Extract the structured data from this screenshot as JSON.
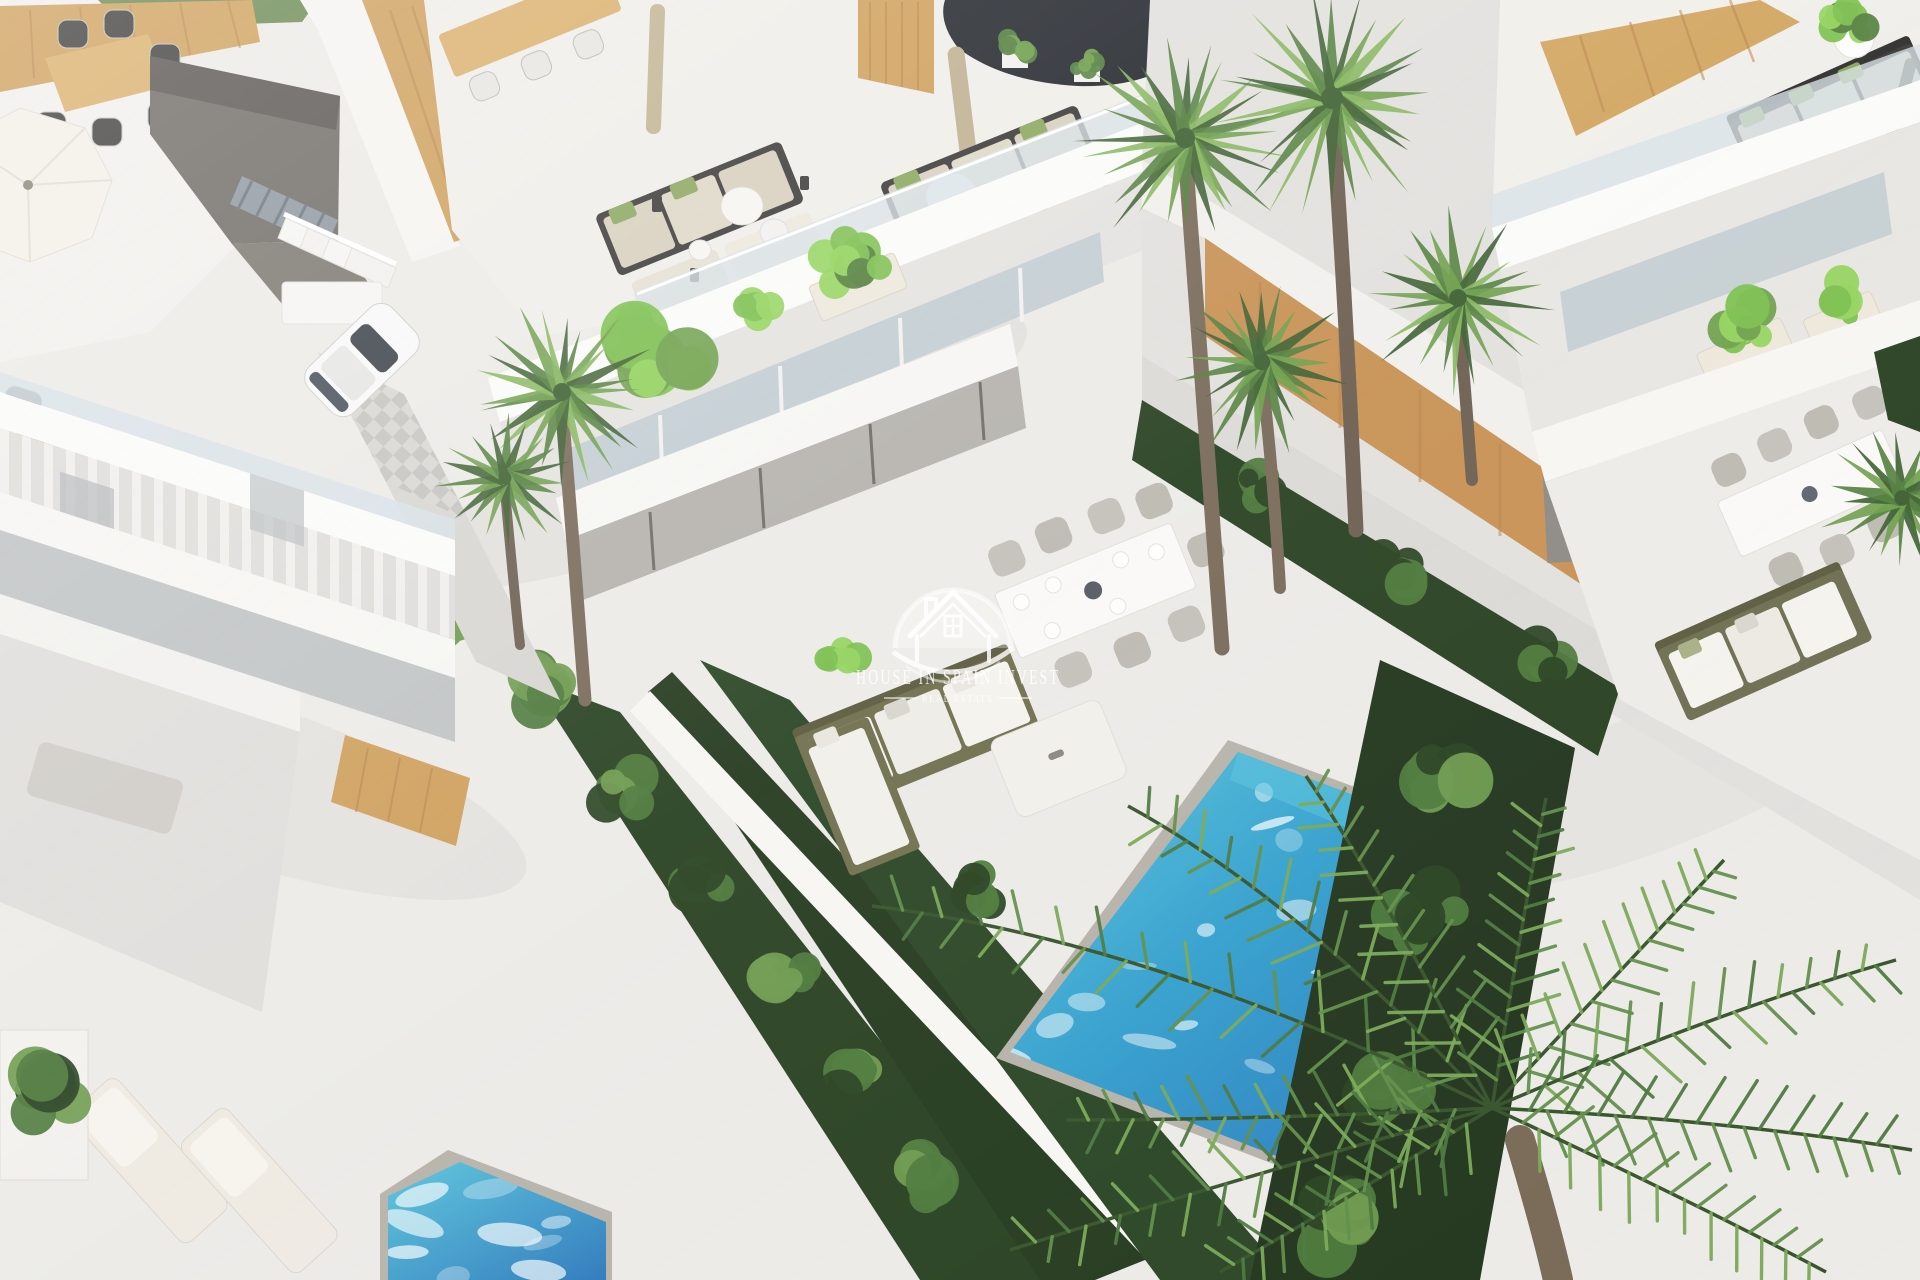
{
  "image": {
    "type": "3d-architectural-render",
    "view": "aerial three-quarter bird's-eye view",
    "description": "Photorealistic CGI render of a row of modern white luxury villas with rooftop lounge terraces, glass balustrades, wood-clad accents, private turquoise pools, landscaped garden strips and palm trees, bright midday light",
    "lighting": "bright sunlight from upper left, soft shadows"
  },
  "watermark": {
    "logo": "house-in-semicircle-logo",
    "line1": "HOUSE IN SPAIN INVEST",
    "line2": "REAL ESTATE",
    "color": "#FFFFFF",
    "opacity": 0.55
  },
  "palette": {
    "deck": "#EDEBE7",
    "deck_shade": "#DBD8D3",
    "wall_white": "#F7F6F3",
    "wall_shade": "#E4E2DE",
    "fascia": "#FBFBF9",
    "wood": "#CFA05C",
    "wood_dark": "#B8834A",
    "wood_light": "#DDB273",
    "glass": "#D7E2E7",
    "glass_dark": "#C3CED3",
    "courtyard": "#6F6B66",
    "courtyard_dark": "#585450",
    "navy": "#23272D",
    "metal": "#8E97A0",
    "paver": "#CFCDC9",
    "paver_alt": "#E2E0DC",
    "pool_light": "#5BC6DD",
    "pool_mid": "#35A0CE",
    "pool_deep": "#2E79BC",
    "ripple": "#F2FAFC",
    "coping": "#B7B3AB",
    "hedge_dark": "#2A4323",
    "bush_mid": "#4E7A3C",
    "bush_light": "#6F9B4F",
    "plant_bright": "#7CC04F",
    "plant_bright2": "#93D45E",
    "palm_dark": "#3E6132",
    "palm_mid": "#54803E",
    "palm_light": "#6FA04C",
    "palm_pale": "#86B65C",
    "frond_dark": "#4E7A40",
    "frond_mid": "#63904B",
    "frond_light": "#7BA958",
    "rib": "#38552C",
    "trunk": "#7A6B5A",
    "trunk_dark": "#5F5346",
    "charcoal": "#3B3A38",
    "cushion": "#D8D0BE",
    "cushion_light": "#EDE8DC",
    "olive": "#71704E",
    "olive_dark": "#5D5C40",
    "white_soft": "#F5F3EE",
    "grass": "#5F804A",
    "canvas_tan": "#C2B493"
  },
  "scene": {
    "buildings": [
      {
        "name": "left-villa",
        "position": "left",
        "features": [
          "rooftop terrace with white parasol and wooden dining table",
          "dark recessed courtyard with metal and white staircases",
          "white parked car on checkered driveway",
          "stacked white balcony bands with glass balustrades and curtains",
          "wood-clad accent wall"
        ]
      },
      {
        "name": "center-villa",
        "position": "center",
        "features": [
          "rooftop lounge with two charcoal-framed sofa sets, beige cushions, green pillows",
          "round white side tables and lanterns",
          "closed tan parasols",
          "wooden privacy screen",
          "dark water feature at roof edge",
          "planted mid-level balcony with banana plants",
          "ground terrace with outdoor dining set, olive L-shaped sofa and white daybed",
          "private turquoise pool"
        ]
      },
      {
        "name": "right-villa",
        "position": "right",
        "features": [
          "rooftop corner sofa with green pillows and round coffee tables",
          "wooden pergola screen",
          "potted plant and patio umbrella",
          "mid-level balcony with stone planters",
          "ground-floor dining terrace with olive sofa",
          "long wood-clad boundary wall"
        ]
      }
    ],
    "pools": [
      {
        "name": "main-pool",
        "location": "center-right",
        "shape": "rectangular, rotated with the plot",
        "colors": [
          "#5BC6DD",
          "#35A0CE",
          "#2E79BC"
        ],
        "detail": "white sun reflections, grey stone coping, overhung by palm fronds"
      },
      {
        "name": "neighbor-pool",
        "location": "bottom-left corner",
        "colors": [
          "#5BC6DD",
          "#2E79BC"
        ]
      }
    ],
    "vegetation": {
      "fan_palms": 7,
      "feather_palm": "large coconut-style palm overhanging bottom-right corner",
      "hedges": "dark green clipped strips between plots and along boundary walls",
      "shrubs": "rounded bushes in diagonal garden strips",
      "banana_plants": 2,
      "planters": "white stone boxes with bright green plants on balconies"
    },
    "furniture_summary": [
      "sun loungers",
      "outdoor dining tables with chairs",
      "L-shaped garden sofas",
      "daybed",
      "round side tables",
      "lanterns",
      "parasols"
    ]
  }
}
